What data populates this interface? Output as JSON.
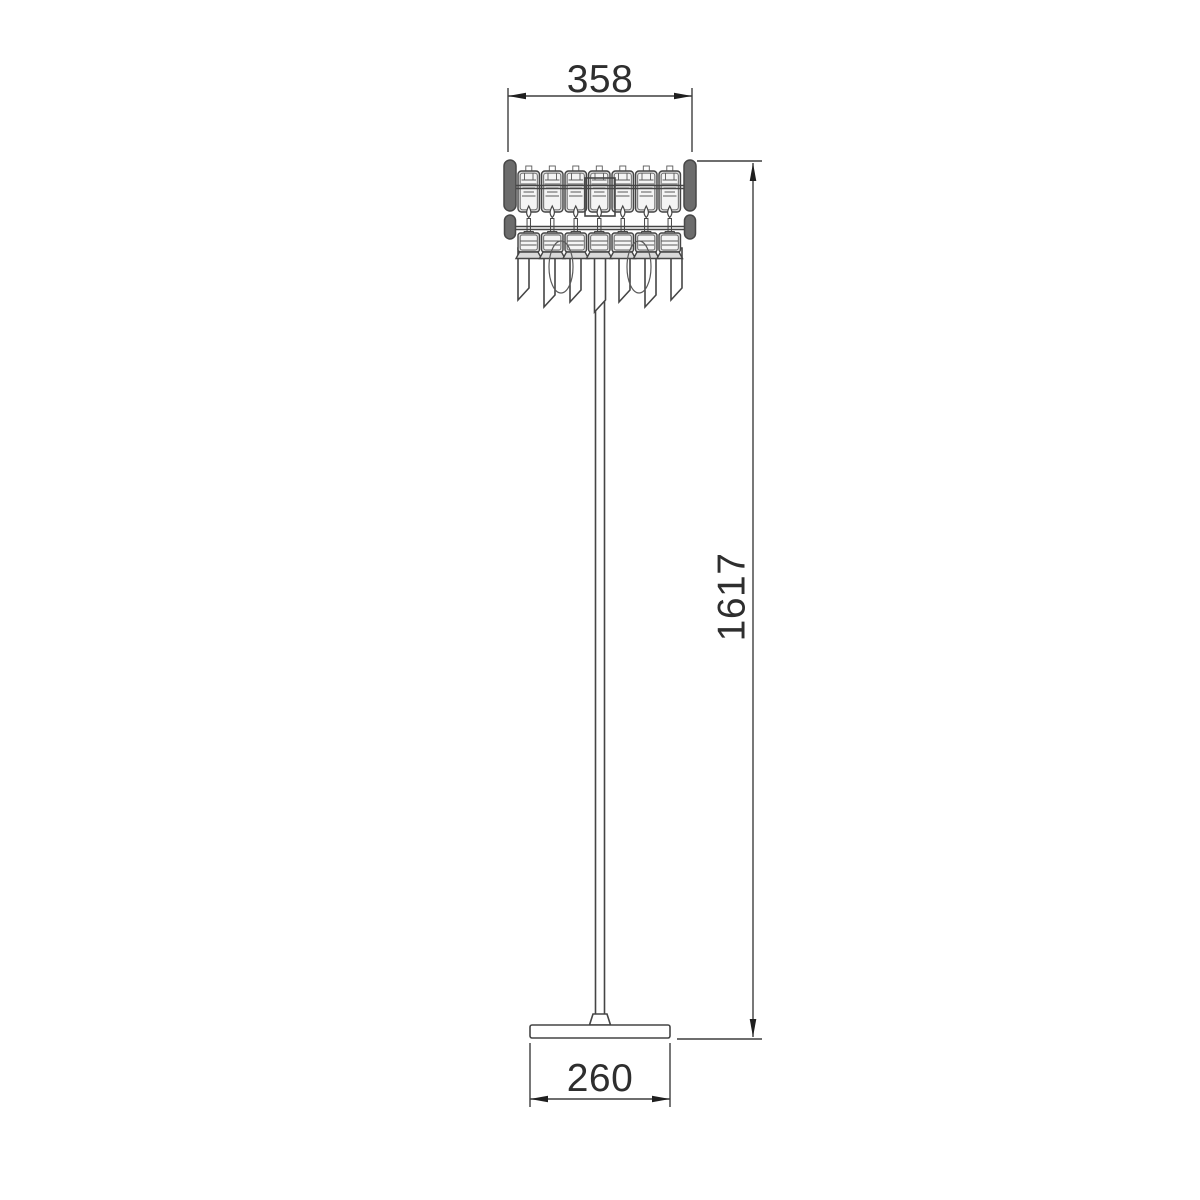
{
  "page": {
    "background": "#ffffff"
  },
  "drawing": {
    "type": "technical-dimension-drawing",
    "subject": "crystal floor lamp",
    "dimensions": {
      "shade_width": "358",
      "total_height": "1617",
      "base_width": "260"
    },
    "colors": {
      "outline": "#454545",
      "dimension_line": "#3f3f3f",
      "text": "#2e2e2e",
      "plate_fill": "#d9d9d9",
      "plate_inner": "#f4f4f4",
      "capsule_fill": "#6c6c6c",
      "background": "#ffffff"
    },
    "parts": [
      "crystal-shade",
      "side-crystal-capsules",
      "candle-bulbs",
      "hanging-prisms",
      "swag-loops",
      "pole",
      "base-plate"
    ]
  }
}
